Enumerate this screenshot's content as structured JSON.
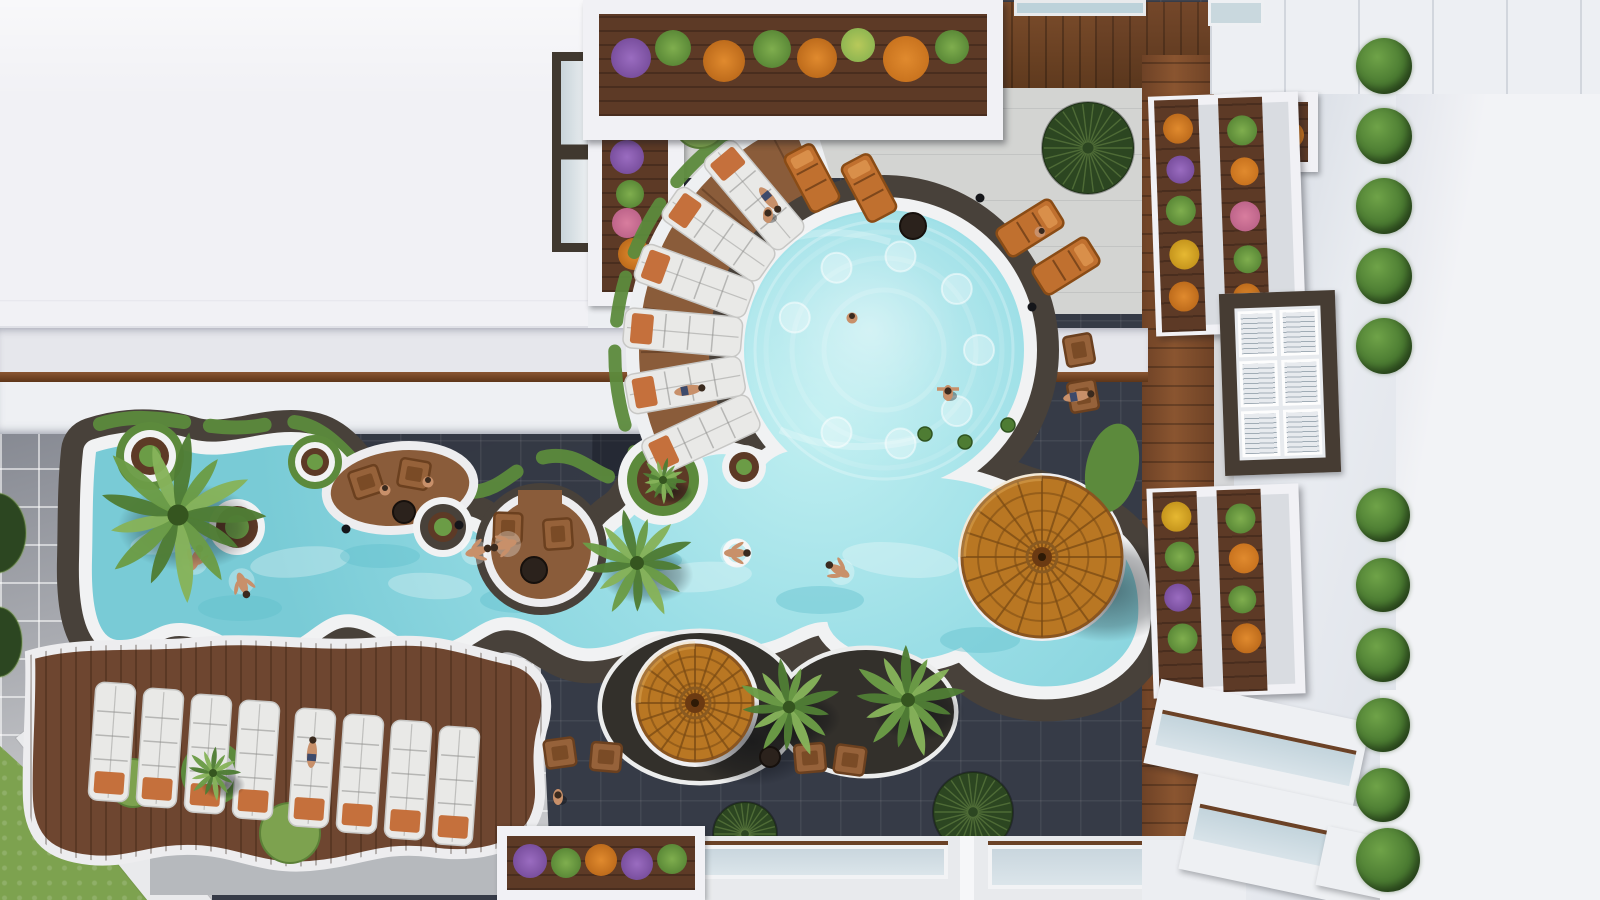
{
  "image": {
    "kind": "aerial-architectural-render",
    "subject": "resort courtyard with freeform lagoon pool, circular main pool, sun decks, parasols and planted balconies",
    "visible_text": ""
  },
  "palette": {
    "plaza": "#363b47",
    "paver": "#c6c7ca",
    "walk": "#d3d4d2",
    "walkWhite": "#e9eaec",
    "wallBand": "#b6b9bd",
    "roof": "#f1f1f5",
    "eaveA": "#e6e7ec",
    "eaveB": "#eef0f3",
    "wallWhite": "#f2f3f6",
    "wood": "#6e4630",
    "wood2": "#5d3a26",
    "woodLight": "#8a5c3a",
    "stone": "#48413a",
    "pebble": "#33302b",
    "rim": "#f1f2f3",
    "water": "#93d9e1",
    "waterLight": "#c6f1f2",
    "waterDeep": "#5bbecb",
    "grass": "#7da24f",
    "grassDark": "#5c8a3c",
    "bushDark": "#2c4621",
    "palm1": "#4f7d35",
    "palm2": "#6b9c46",
    "palm3": "#86b35a",
    "umbrella": "#b97723",
    "umbrellaLine": "#7a4a14",
    "lounger": "#e9e9e7",
    "towel": "#c5703c",
    "loungerOrange": "#c0702f",
    "chairWood": "#96623a",
    "skin": "#c8906a",
    "hair": "#3a2a1e",
    "glass": "#bcd2da",
    "frameDark": "#463c33",
    "flowerOrange": "#e08a2e",
    "flowerYellow": "#e6b832",
    "flowerPurple": "#9a6cc0",
    "flowerPink": "#d87d9e",
    "flowerGreen": "#7fae4e"
  },
  "scene": {
    "main_pool": {
      "cx": 884,
      "cy": 350,
      "r": 140
    },
    "river_lobes": [
      {
        "cx": 800,
        "cy": 490,
        "rx": 45,
        "ry": 40
      },
      {
        "cx": 905,
        "cy": 618,
        "rx": 78,
        "ry": 42
      }
    ],
    "deck_sector": {
      "a1": 143,
      "a2": 248,
      "rIn": 158,
      "rOut": 245
    },
    "apron_sector": {
      "a1": 138,
      "a2": 253,
      "rIn": 150,
      "rOut": 258
    },
    "radial_loungers": [
      155,
      170,
      185,
      200,
      215,
      230
    ],
    "row_loungers": [
      {
        "x": 112,
        "y": 742
      },
      {
        "x": 160,
        "y": 748
      },
      {
        "x": 208,
        "y": 754
      },
      {
        "x": 256,
        "y": 760
      },
      {
        "x": 312,
        "y": 768
      },
      {
        "x": 360,
        "y": 774
      },
      {
        "x": 408,
        "y": 780
      },
      {
        "x": 456,
        "y": 786
      }
    ],
    "orange_loungers": [
      {
        "x": 812,
        "y": 178,
        "rot": -28
      },
      {
        "x": 869,
        "y": 188,
        "rot": -28
      },
      {
        "x": 1030,
        "y": 228,
        "rot": 58
      },
      {
        "x": 1066,
        "y": 266,
        "rot": 58
      }
    ],
    "wood_chairs": [
      {
        "x": 1079,
        "y": 350,
        "rot": 80
      },
      {
        "x": 1083,
        "y": 396,
        "rot": 80
      },
      {
        "x": 560,
        "y": 753,
        "rot": -8
      },
      {
        "x": 606,
        "y": 757,
        "rot": 5
      },
      {
        "x": 810,
        "y": 758,
        "rot": -5
      },
      {
        "x": 850,
        "y": 760,
        "rot": 8
      },
      {
        "x": 366,
        "y": 482,
        "rot": -18
      },
      {
        "x": 414,
        "y": 474,
        "rot": 10
      },
      {
        "x": 508,
        "y": 528,
        "rot": 92
      },
      {
        "x": 558,
        "y": 534,
        "rot": 86
      }
    ],
    "tables": [
      {
        "x": 913,
        "y": 226,
        "r": 13
      },
      {
        "x": 404,
        "y": 512,
        "r": 11
      },
      {
        "x": 534,
        "y": 570,
        "r": 13
      },
      {
        "x": 770,
        "y": 757,
        "r": 10
      }
    ],
    "umbrellas": [
      {
        "x": 1042,
        "y": 557,
        "r": 80
      },
      {
        "x": 695,
        "y": 703,
        "r": 58
      }
    ],
    "palms": [
      {
        "x": 178,
        "y": 515,
        "r": 88
      },
      {
        "x": 637,
        "y": 563,
        "r": 58
      },
      {
        "x": 789,
        "y": 707,
        "r": 52
      },
      {
        "x": 908,
        "y": 700,
        "r": 58
      },
      {
        "x": 213,
        "y": 773,
        "r": 28
      },
      {
        "x": 663,
        "y": 480,
        "r": 24
      }
    ],
    "fan_shrubs": [
      {
        "x": 1088,
        "y": 148,
        "r": 46
      },
      {
        "x": 973,
        "y": 812,
        "r": 40
      },
      {
        "x": 745,
        "y": 834,
        "r": 32
      }
    ],
    "grass_circles": [
      {
        "x": 133,
        "y": 783,
        "r": 24
      },
      {
        "x": 290,
        "y": 833,
        "r": 30
      },
      {
        "x": 700,
        "y": 122,
        "r": 26
      }
    ],
    "grass_ellipse": {
      "x": 1112,
      "y": 468,
      "rx": 26,
      "ry": 45,
      "rot": 12
    },
    "half_bushes": [
      {
        "x": -4,
        "y": 533,
        "rx": 30,
        "ry": 40
      },
      {
        "x": -2,
        "y": 642,
        "rx": 24,
        "ry": 35
      }
    ],
    "planters": [
      {
        "x": 150,
        "y": 456,
        "rings": [
          [
            "grassDark",
            34
          ],
          [
            "rim",
            26
          ],
          [
            "wood2",
            19
          ],
          [
            "palm2",
            11
          ]
        ]
      },
      {
        "x": 315,
        "y": 462,
        "rings": [
          [
            "grassDark",
            27
          ],
          [
            "rim",
            20
          ],
          [
            "wood2",
            14
          ],
          [
            "palm2",
            8
          ]
        ]
      },
      {
        "x": 237,
        "y": 527,
        "rings": [
          [
            "rim",
            28
          ],
          [
            "wood2",
            21
          ],
          [
            "palm2",
            12
          ]
        ]
      },
      {
        "x": 443,
        "y": 527,
        "rings": [
          [
            "rim",
            30
          ],
          [
            "stone",
            23
          ],
          [
            "wood2",
            15
          ],
          [
            "palm2",
            9
          ]
        ]
      },
      {
        "x": 663,
        "y": 480,
        "rings": [
          [
            "rim",
            45
          ],
          [
            "grassDark",
            36
          ],
          [
            "wood2",
            26
          ],
          [
            "palm2",
            14
          ]
        ]
      },
      {
        "x": 744,
        "y": 467,
        "rings": [
          [
            "rim",
            22
          ],
          [
            "wood2",
            15
          ],
          [
            "palm2",
            8
          ]
        ]
      },
      {
        "x": 213,
        "y": 773,
        "rings": [
          [
            "grassDark",
            32
          ],
          [
            "paver",
            22
          ],
          [
            "rim",
            15
          ],
          [
            "wood2",
            9
          ]
        ]
      }
    ],
    "tufts": [
      {
        "x": 648,
        "y": 80
      },
      {
        "x": 752,
        "y": 74
      },
      {
        "x": 1008,
        "y": 425
      },
      {
        "x": 965,
        "y": 442
      },
      {
        "x": 925,
        "y": 434
      }
    ],
    "bollards": [
      {
        "x": 1032,
        "y": 307
      },
      {
        "x": 980,
        "y": 198
      },
      {
        "x": 1048,
        "y": 624
      },
      {
        "x": 346,
        "y": 529
      },
      {
        "x": 459,
        "y": 525
      }
    ],
    "people": [
      {
        "x": 196,
        "y": 558,
        "rot": 20,
        "pose": "swim"
      },
      {
        "x": 243,
        "y": 585,
        "rot": 160,
        "pose": "swim"
      },
      {
        "x": 478,
        "y": 551,
        "rot": 75,
        "pose": "swim"
      },
      {
        "x": 504,
        "y": 545,
        "rot": 255,
        "pose": "swim"
      },
      {
        "x": 737,
        "y": 553,
        "rot": 90,
        "pose": "ring"
      },
      {
        "x": 838,
        "y": 570,
        "rot": 300,
        "pose": "swim"
      },
      {
        "x": 948,
        "y": 393,
        "rot": 0,
        "pose": "stand-arms"
      },
      {
        "x": 760,
        "y": 122,
        "rot": 0,
        "pose": "stand"
      },
      {
        "x": 768,
        "y": 215,
        "rot": 0,
        "pose": "stand"
      },
      {
        "x": 558,
        "y": 797,
        "rot": 0,
        "pose": "stand"
      },
      {
        "x": 1228,
        "y": 764,
        "rot": 0,
        "pose": "stand"
      },
      {
        "x": 312,
        "y": 752,
        "rot": 4,
        "pose": "lie"
      },
      {
        "x": 690,
        "y": 390,
        "rot": 80,
        "pose": "lie"
      },
      {
        "x": 770,
        "y": 200,
        "rot": 140,
        "pose": "lie"
      },
      {
        "x": 1079,
        "y": 396,
        "rot": 80,
        "pose": "lie"
      },
      {
        "x": 852,
        "y": 318,
        "rot": 0,
        "pose": "sit"
      },
      {
        "x": 385,
        "y": 490,
        "rot": 0,
        "pose": "sit"
      },
      {
        "x": 428,
        "y": 482,
        "rot": 0,
        "pose": "sit"
      },
      {
        "x": 1040,
        "y": 232,
        "rot": 58,
        "pose": "sit"
      }
    ],
    "hedge_bushes": [
      38,
      108,
      178,
      248,
      318,
      488,
      558,
      628,
      698,
      768,
      828
    ]
  }
}
